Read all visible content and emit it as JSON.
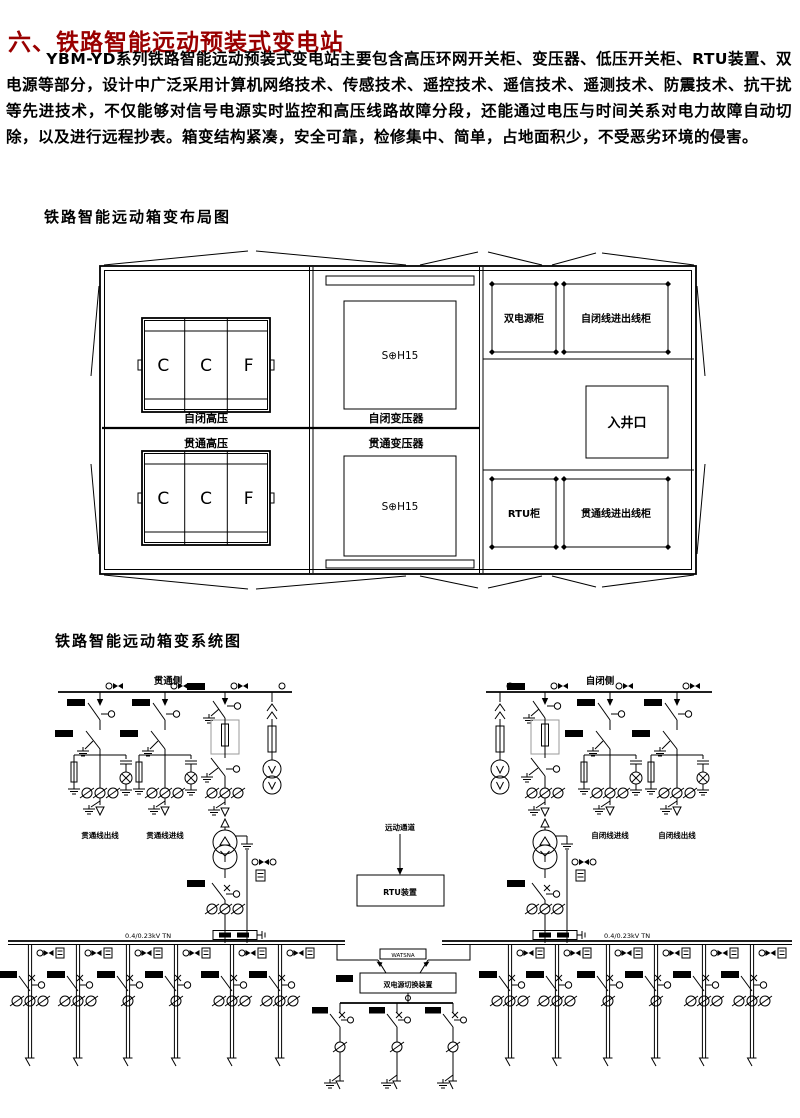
{
  "page": {
    "title": "六、铁路智能远动预装式变电站",
    "title_color": "#990000",
    "intro": "YBM-YD系列铁路智能远动预装式变电站主要包含高压环网开关柜、变压器、低压开关柜、RTU装置、双电源等部分，设计中广泛采用计算机网络技术、传感技术、遥控技术、遥信技术、遥测技术、防震技术、抗干扰等先进技术，不仅能够对信号电源实时监控和高压线路故障分段，还能通过电压与时间关系对电力故障自动切除，以及进行远程抄表。箱变结构紧凑，安全可靠，检修集中、简单，占地面积少，不受恶劣环境的侵害。"
  },
  "layout_diagram": {
    "heading": "铁路智能远动箱变布局图",
    "rooms": {
      "top_hv_label": "自闭高压",
      "bottom_hv_label": "贯通高压",
      "top_tx_label": "自闭变压器",
      "bottom_tx_label": "贯通变压器",
      "cabinet_letters": [
        "C",
        "C",
        "F"
      ],
      "transformer_model": "S⊕H15",
      "dual_power_cabinet": "双电源柜",
      "zibi_io_cabinet": "自闭线进出线柜",
      "manhole": "入井口",
      "rtu_cabinet": "RTU柜",
      "guantong_io_cabinet": "贯通线进出线柜"
    }
  },
  "system_diagram": {
    "heading": "铁路智能远动箱变系统图",
    "guantong_bus_label": "贯通侧",
    "zibi_bus_label": "自闭侧",
    "guantong_feeders": [
      "贯通线出线",
      "贯通线进线"
    ],
    "zibi_feeders": [
      "自闭线进线",
      "自闭线出线"
    ],
    "remote_channel_label": "远动通道",
    "rtu_box_label": "RTU装置",
    "ats_model_label": "WATSNA",
    "ats_box_label": "双电源切换装置",
    "lv_bus_label": "0.4/0.23kV TN"
  }
}
